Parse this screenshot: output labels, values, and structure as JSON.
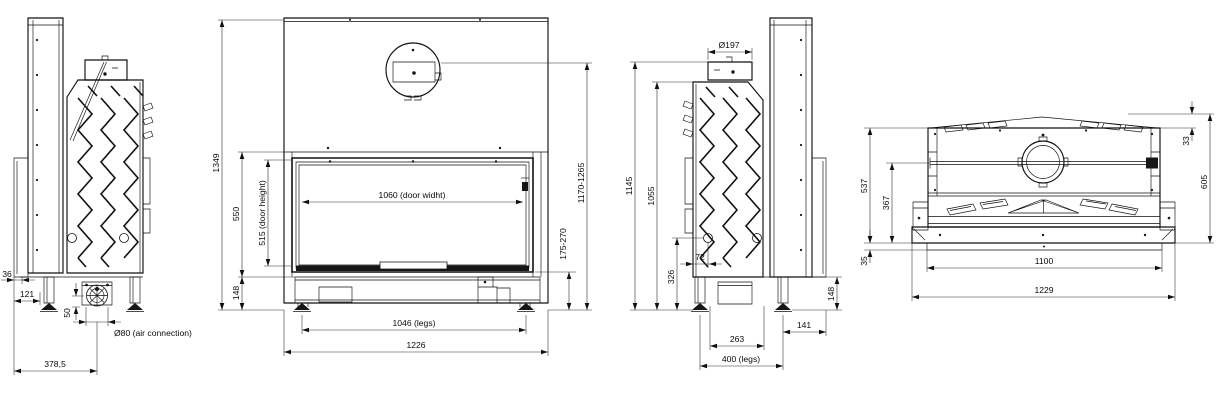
{
  "drawing": {
    "background": "#ffffff",
    "line_color": "#111111",
    "views": {
      "side_left": {
        "dims": {
          "bracket_offset": "36",
          "bracket_depth": "121",
          "air_height": "50",
          "air_connection": "Ø80 (air connection)",
          "total_depth": "378,5"
        }
      },
      "front": {
        "dims": {
          "total_height": "1349",
          "firebox_height": "550",
          "door_height": "515 (door height)",
          "base_height": "148",
          "door_width": "1060 (door widht)",
          "flue_height_range": "1170-1265",
          "base_height_range": "175-270",
          "legs_width": "1046 (legs)",
          "total_width": "1226"
        }
      },
      "side_right": {
        "dims": {
          "flue_diameter": "Ø197",
          "height_to_flue": "1145",
          "body_height": "1055",
          "air_inlet_height": "326",
          "air_inlet_offset": "72",
          "base_height": "148",
          "rear_offset": "141",
          "depth_inner": "263",
          "legs_depth": "400 (legs)"
        }
      },
      "top": {
        "dims": {
          "top_strip": "33",
          "body_depth": "537",
          "flue_center_depth": "367",
          "total_depth": "605",
          "base_lip": "35",
          "inner_width": "1100",
          "total_width": "1229"
        }
      }
    }
  }
}
